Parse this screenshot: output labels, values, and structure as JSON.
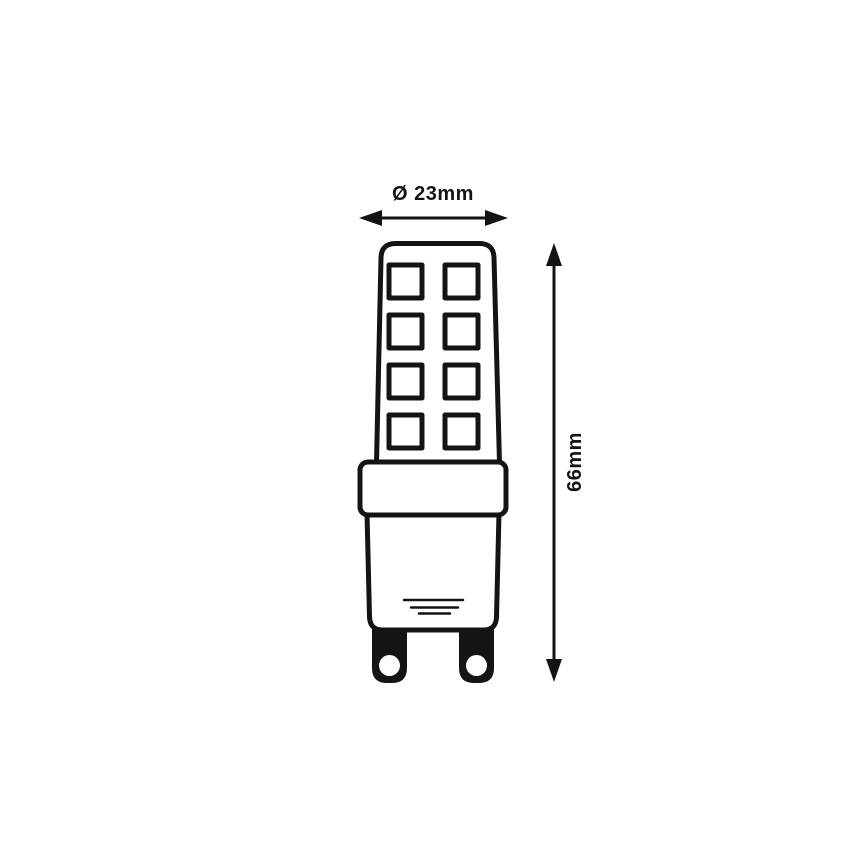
{
  "page": {
    "background_color": "#ffffff"
  },
  "diagram": {
    "type": "technical-dimension-drawing",
    "line_color": "#141414",
    "fill_color": "#ffffff",
    "width_dimension": {
      "label": "Ø 23mm",
      "value_mm": 23,
      "orientation": "horizontal"
    },
    "height_dimension": {
      "label": "66mm",
      "value_mm": 66,
      "orientation": "vertical"
    },
    "led_chip_grid": {
      "rows": 4,
      "columns": 2
    }
  }
}
